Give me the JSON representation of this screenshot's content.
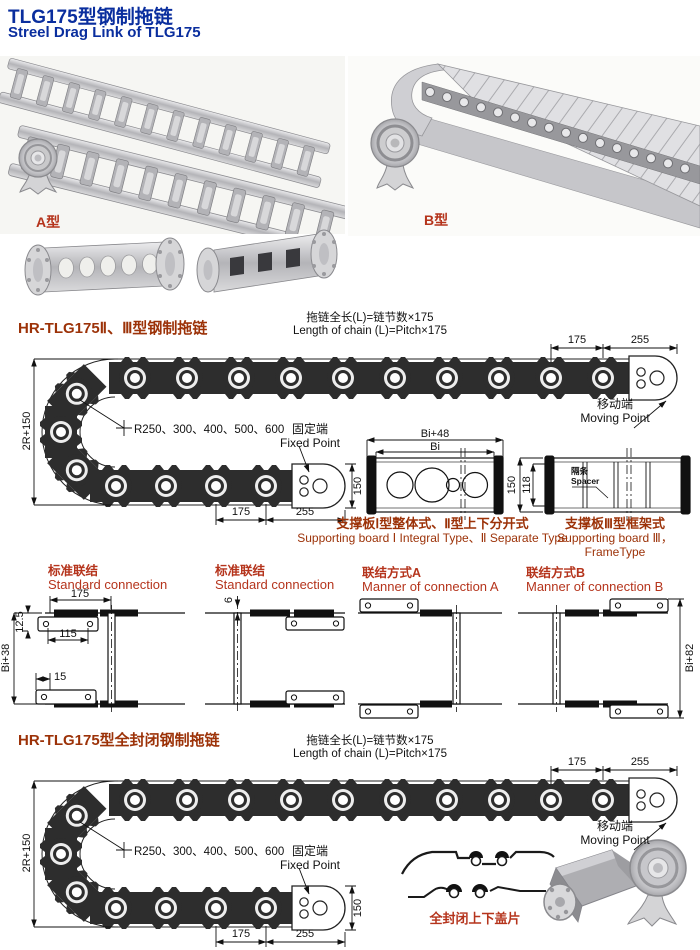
{
  "header": {
    "title_cn": "TLG175型钢制拖链",
    "title_en": "Streel Drag Link of TLG175"
  },
  "photos": {
    "label_a": "A型",
    "label_b": "B型"
  },
  "drawing1": {
    "heading": "HR-TLG175Ⅱ、Ⅲ型钢制拖链",
    "formula_cn": "拖链全长(L)=链节数×175",
    "formula_en": "Length of chain (L)=Pitch×175",
    "dim_top_175": "175",
    "dim_top_255": "255",
    "dim_left": "2R+150",
    "radius_note": "R250、300、400、500、600",
    "fixed_cn": "固定端",
    "fixed_en": "Fixed Point",
    "dim_150": "150",
    "dim_bot_175": "175",
    "dim_bot_255": "255",
    "moving_cn": "移动端",
    "moving_en": "Moving Point"
  },
  "boards": {
    "dim_bi48": "Bi+48",
    "dim_bi": "Bi",
    "caption12_cn": "支撑板Ⅰ型整体式、Ⅱ型上下分开式",
    "caption12_en": "Supporting board Ⅰ Integral Type、Ⅱ Separate Type",
    "dim_150": "150",
    "dim_118": "118",
    "spacer_cn": "隔条",
    "spacer_en": "Spacer",
    "caption3_cn": "支撑板Ⅲ型框架式",
    "caption3_en": "Supporting board Ⅲ，FrameType"
  },
  "connections": {
    "c1_cn": "标准联结",
    "c1_en": "Standard connection",
    "c1_dim_175": "175",
    "c1_dim_12_5": "12.5",
    "c1_dim_115": "115",
    "c1_dim_bi38": "Bi+38",
    "c1_dim_15": "15",
    "c2_cn": "标准联结",
    "c2_en": "Standard connection",
    "c2_dim_6": "6",
    "c3_cn": "联结方式A",
    "c3_en": "Manner of connection A",
    "c4_cn": "联结方式B",
    "c4_en": "Manner of connection B",
    "c4_dim_bi82": "Bi+82"
  },
  "drawing2": {
    "heading": "HR-TLG175型全封闭钢制拖链",
    "formula_cn": "拖链全长(L)=链节数×175",
    "formula_en": "Length of chain (L)=Pitch×175",
    "dim_top_175": "175",
    "dim_top_255": "255",
    "dim_left": "2R+150",
    "radius_note": "R250、300、400、500、600",
    "fixed_cn": "固定端",
    "fixed_en": "Fixed Point",
    "dim_150": "150",
    "dim_bot_175": "175",
    "dim_bot_255": "255",
    "moving_cn": "移动端",
    "moving_en": "Moving Point",
    "cover_caption": "全封闭上下盖片"
  }
}
